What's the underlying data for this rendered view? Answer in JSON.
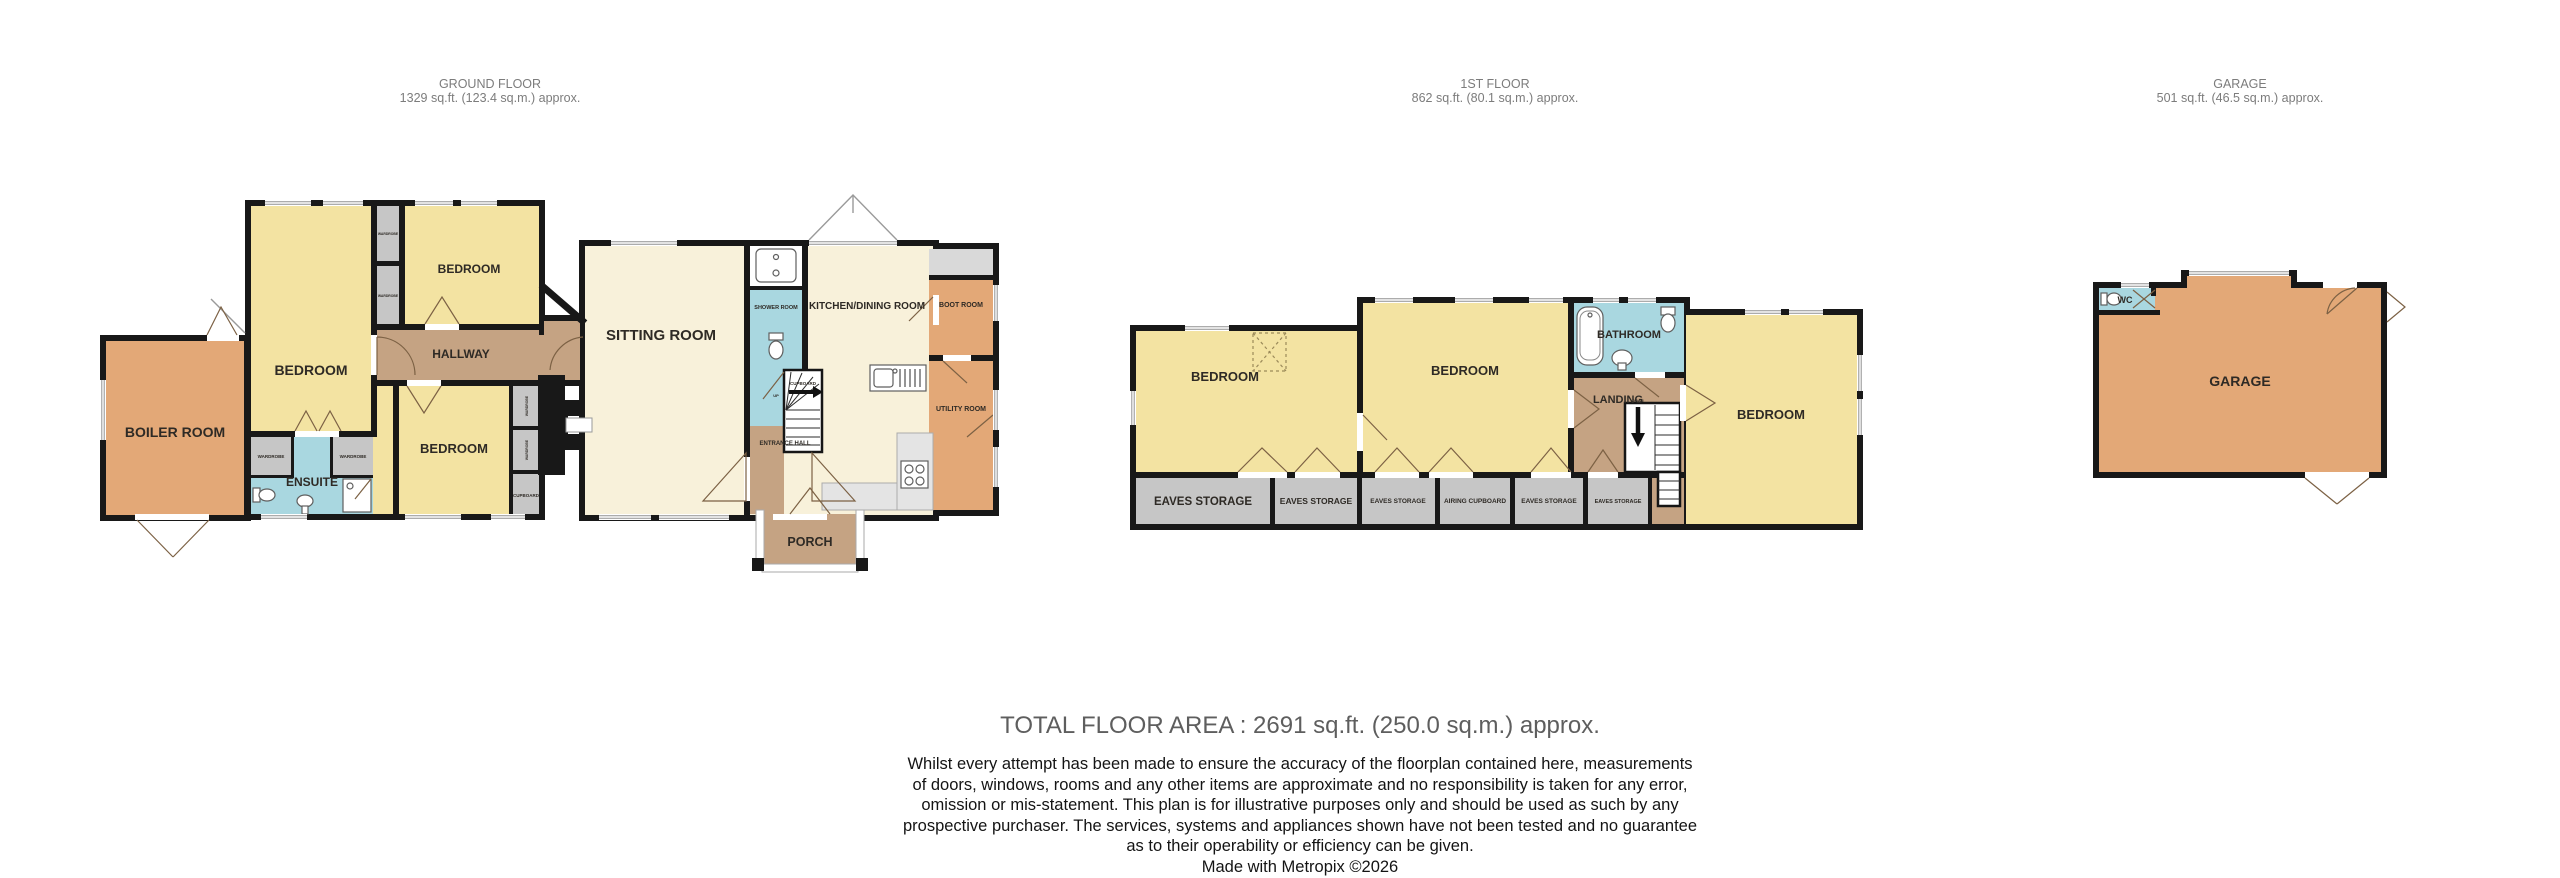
{
  "colors": {
    "wall": "#181818",
    "yellow": "#F3E3A2",
    "cream": "#F8F1DA",
    "tan": "#C5A383",
    "orange": "#E3A877",
    "blue": "#A9D7E0",
    "closet": "#C6C6C6",
    "counter": "#E4E4E4",
    "label": "#2E2A25",
    "header_text": "#7C7C7C",
    "total_text": "#5E5E5E",
    "body_text": "#141414"
  },
  "headers": [
    {
      "title": "GROUND FLOOR",
      "area": "1329 sq.ft. (123.4 sq.m.) approx."
    },
    {
      "title": "1ST FLOOR",
      "area": "862 sq.ft. (80.1 sq.m.) approx."
    },
    {
      "title": "GARAGE",
      "area": "501 sq.ft. (46.5 sq.m.) approx."
    }
  ],
  "rooms": {
    "bedroom": "BEDROOM",
    "boiler_room": "BOILER ROOM",
    "hallway": "HALLWAY",
    "ensuite": "ENSUITE",
    "wardrobe": "WARDROBE",
    "cupboard": "CUPBOARD",
    "sitting_room": "SITTING ROOM",
    "shower_room": "SHOWER ROOM",
    "entrance_hall": "ENTRANCE HALL",
    "up": "UP",
    "kitchen_dining": "KITCHEN/DINING ROOM",
    "boot_room": "BOOT ROOM",
    "utility_room": "UTILITY ROOM",
    "porch": "PORCH",
    "bathroom": "BATHROOM",
    "landing": "LANDING",
    "down": "DOWN",
    "eaves_storage": "EAVES STORAGE",
    "airing_cupboard": "AIRING CUPBOARD",
    "garage": "GARAGE",
    "wc": "WC"
  },
  "footer": {
    "total": "TOTAL FLOOR AREA : 2691 sq.ft. (250.0 sq.m.) approx.",
    "disclaimer_lines": [
      "Whilst every attempt has been made to ensure the accuracy of the floorplan contained here, measurements",
      "of doors, windows, rooms and any other items are approximate and no responsibility is taken for any error,",
      "omission or mis-statement. This plan is for illustrative purposes only and should be used as such by any",
      "prospective purchaser. The services, systems and appliances shown have not been tested and no guarantee",
      "as to their operability or efficiency can be given."
    ],
    "credit": "Made with Metropix ©2026"
  }
}
